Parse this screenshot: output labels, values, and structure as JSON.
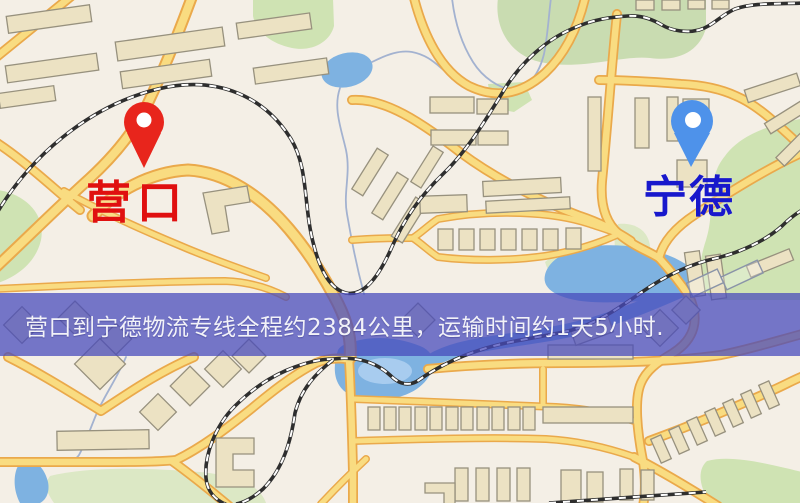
{
  "banner": {
    "text": "营口到宁德物流专线全程约2384公里，运输时间约1天5小时.",
    "background_color": "#4a4abc",
    "text_color": "#f2f2f8"
  },
  "markers": {
    "origin": {
      "label": "营口",
      "label_color": "#e01010",
      "pin_color": "#e8251c"
    },
    "destination": {
      "label": "宁德",
      "label_color": "#1818cc",
      "pin_color": "#4e92ea"
    }
  },
  "map": {
    "background_color": "#f4efe6",
    "road_fill_color": "#f8dc83",
    "road_casing_color": "#e9a94d",
    "water_color": "#7fb2e0",
    "park_color": "#cfe3b4",
    "railway_color": "#2e2e2e",
    "building_color": "#ece2c4"
  }
}
